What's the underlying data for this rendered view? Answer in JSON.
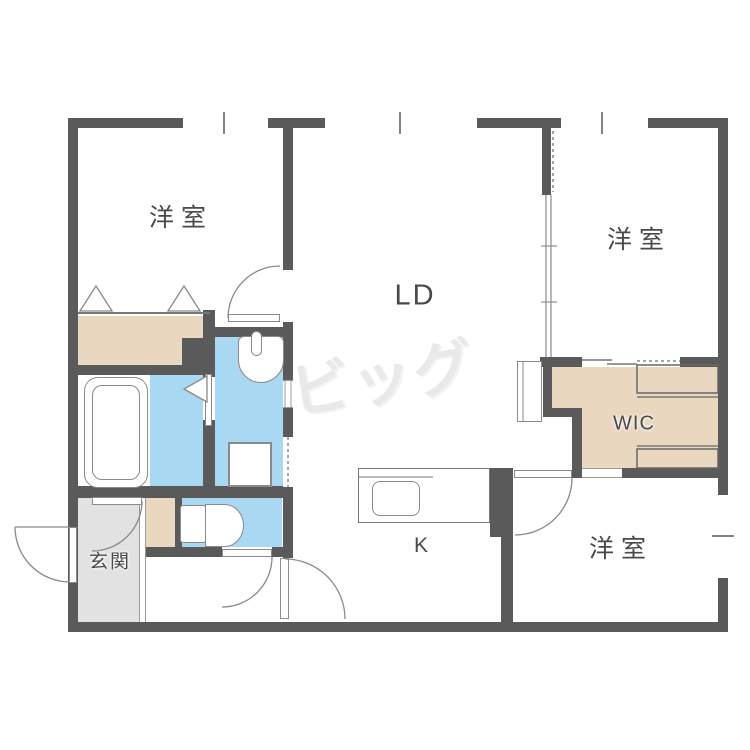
{
  "floorplan": {
    "watermark_text": "ビッグ",
    "rooms": {
      "bedroom_nw": "洋室",
      "living_dining": "LD",
      "bedroom_ne": "洋室",
      "wic": "WIC",
      "bedroom_se": "洋室",
      "kitchen": "K",
      "entrance": "玄関"
    },
    "colors": {
      "wall": "#5a5a5a",
      "wet_area": "#a9d8f3",
      "closet": "#e9d7bf",
      "entrance_floor": "#e2e2e2",
      "fixture_outline": "#8a8a8a",
      "label_text": "#4a4a4a",
      "watermark": "#e9e9e9"
    }
  }
}
